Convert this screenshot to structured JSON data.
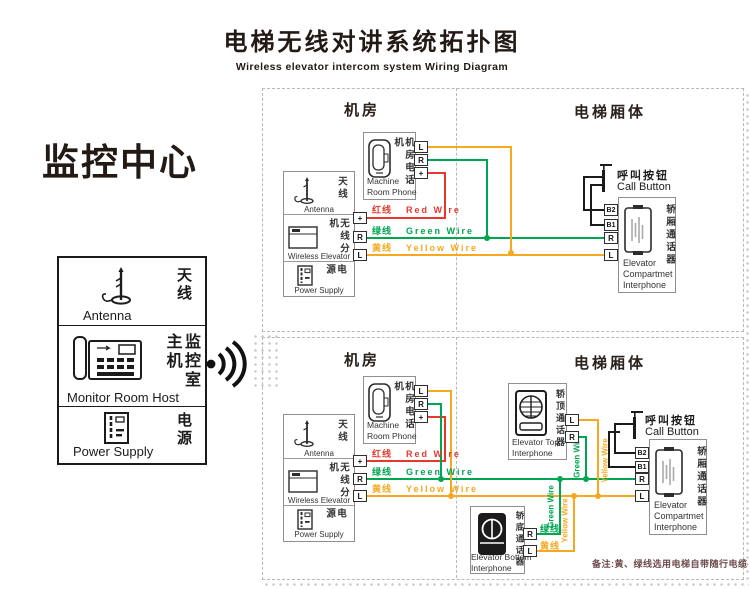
{
  "title": {
    "zh": "电梯无线对讲系统拓扑图",
    "en": "Wireless elevator intercom system Wiring Diagram"
  },
  "monitor_center": {
    "heading": "监控中心",
    "rows": [
      {
        "zh": "天线",
        "en": "Antenna"
      },
      {
        "zh": "监控室主机",
        "en": "Monitor Room Host"
      },
      {
        "zh": "电源",
        "en": "Power Supply"
      }
    ]
  },
  "section_headers": {
    "machine_room": "机房",
    "elevator_car": "电梯厢体"
  },
  "devices": {
    "machine_room_phone": {
      "zh": "机房电话机",
      "en_line1": "Machine",
      "en_line2": "Room Phone"
    },
    "antenna": {
      "zh": "天线",
      "en": "Antenna"
    },
    "wireless_elevator": {
      "zh": "无线分机",
      "en": "Wireless Elevator"
    },
    "power_supply": {
      "zh": "电源",
      "en": "Power Supply"
    },
    "call_button": {
      "zh": "呼叫按钮",
      "en": "Call Button"
    },
    "compartment_interphone": {
      "zh": "轿厢通话器",
      "en_line1": "Elevator",
      "en_line2": "Compartmet",
      "en_line3": "Interphone"
    },
    "top_interphone": {
      "zh": "轿顶通话器",
      "en_line1": "Elevator Top",
      "en_line2": "Interphone"
    },
    "bottom_interphone": {
      "zh": "轿底通话器",
      "en_line1": "Elevator Bottom",
      "en_line2": "Interphone"
    }
  },
  "terminals": {
    "L": "L",
    "R": "R",
    "plus": "+",
    "B1": "B1",
    "B2": "B2"
  },
  "wires": {
    "red": {
      "zh": "红线",
      "en": "Red Wire",
      "color": "#e6392c"
    },
    "green": {
      "zh": "绿线",
      "en": "Green Wire",
      "color": "#00a551"
    },
    "yellow": {
      "zh": "黄线",
      "en": "Yellow Wire",
      "color": "#f6a81f"
    }
  },
  "note": "备注:黄、绿线选用电梯自带随行电缆",
  "icons": {
    "signal": "wireless-signal-icon"
  }
}
